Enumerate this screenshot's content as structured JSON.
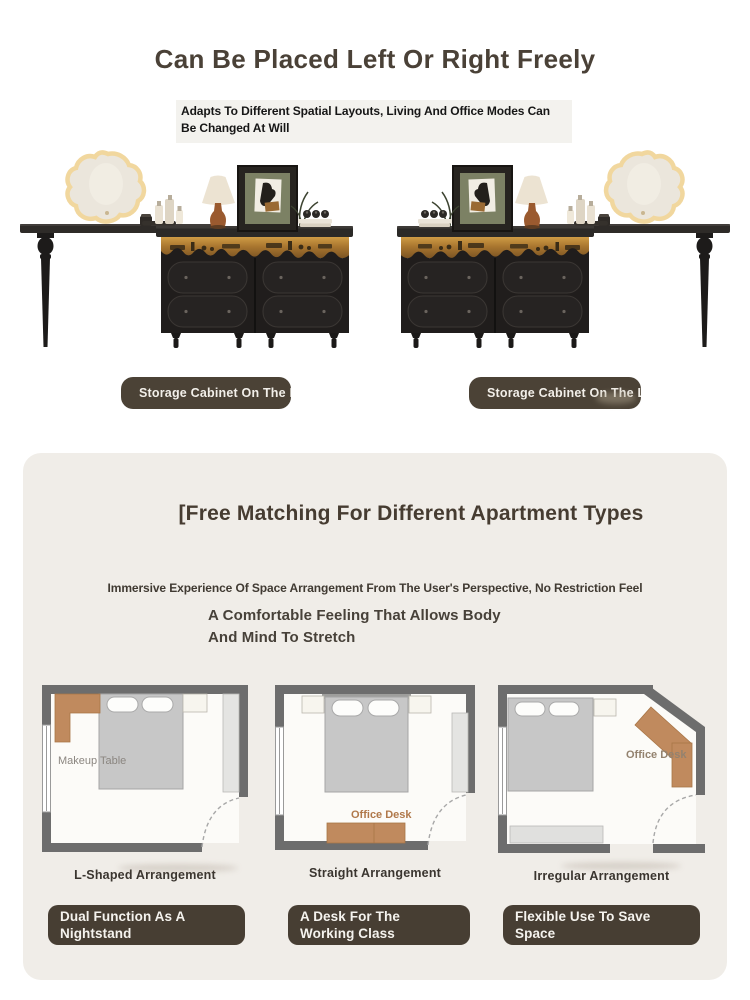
{
  "hero": {
    "title": "Can Be Placed Left Or Right Freely",
    "subtitle": "Adapts To Different Spatial Layouts, Living And Office Modes Can Be Changed At Will",
    "badges": [
      "Storage Cabinet On The Right",
      "Storage Cabinet On The Left"
    ]
  },
  "card": {
    "title": "[Free Matching For Different Apartment Types",
    "lead": "Immersive Experience Of Space Arrangement From The User's Perspective, No Restriction Feel",
    "sublead_line1": "A Comfortable Feeling That Allows Body",
    "sublead_line2": "And Mind To Stretch",
    "plans": [
      {
        "furniture_label": "Makeup Table",
        "caption": "L-Shaped Arrangement",
        "badge_line1": "Dual Function As A",
        "badge_line2": "Nightstand"
      },
      {
        "furniture_label": "Office Desk",
        "caption": "Straight Arrangement",
        "badge_line1": "A Desk For The",
        "badge_line2": "Working Class"
      },
      {
        "furniture_label": "Office Desk",
        "caption": "Irregular Arrangement",
        "badge_line1": "Flexible Use To Save",
        "badge_line2": "Space"
      }
    ]
  },
  "colors": {
    "heading": "#4a4137",
    "badge_bg": "#4b4236",
    "card_bg": "#f0ede8",
    "wood_accent": "#c08a5e",
    "wall_gray": "#6d6d6d"
  }
}
